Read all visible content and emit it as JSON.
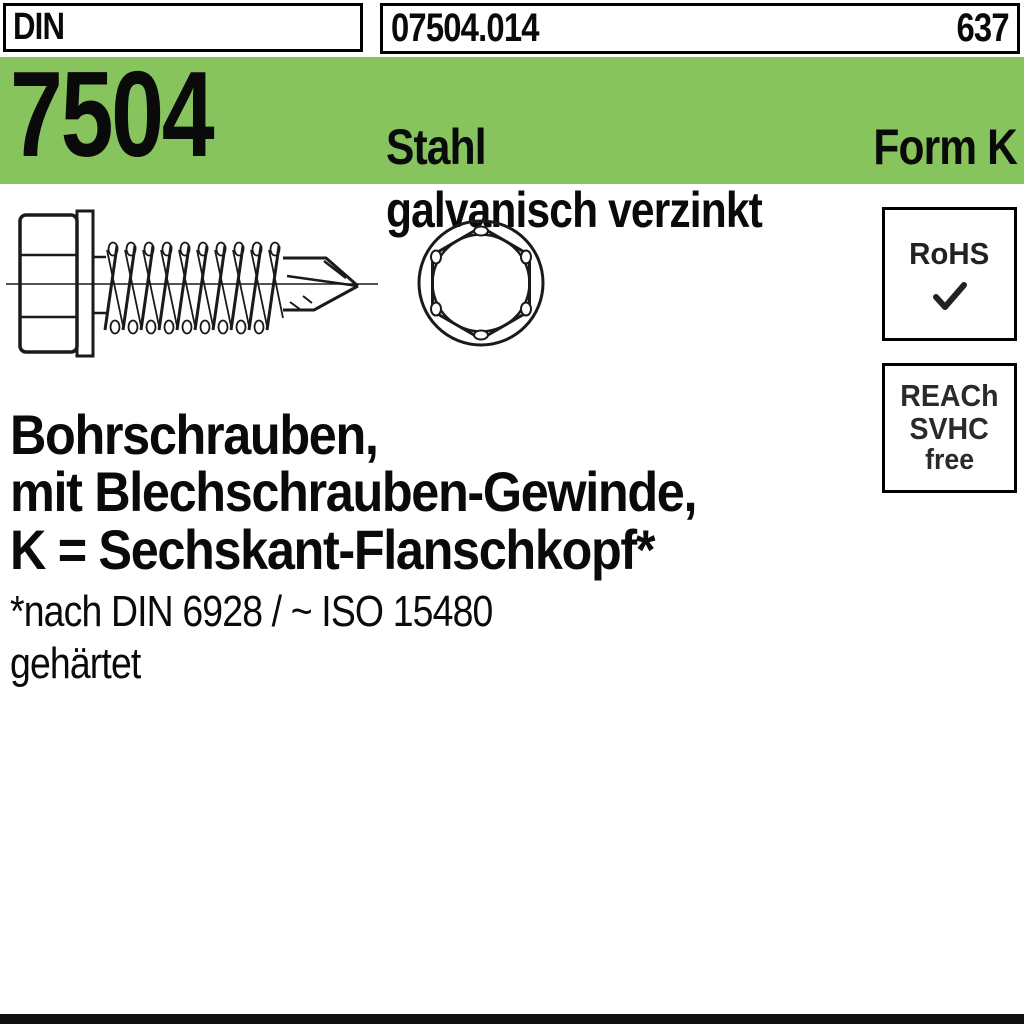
{
  "colors": {
    "banner_green": "#87C45E",
    "text_black": "#0a0a0a",
    "badge_text_gray": "#2a2a2a",
    "bottom_bar_black": "#0f0f0f"
  },
  "header": {
    "din_label": "DIN",
    "article_number": "07504.014",
    "page_number": "637"
  },
  "banner": {
    "standard_number": "7504",
    "material": "Stahl",
    "finish": "galvanisch verzinkt",
    "form": "Form K"
  },
  "drawing": {
    "side_view_icon": "self-drilling-screw-side-view",
    "top_view_icon": "hex-flange-head-top-view"
  },
  "compliance": {
    "rohs_label": "RoHS",
    "rohs_check_icon": "check-icon",
    "reach_line1": "REACh",
    "reach_line2": "SVHC",
    "reach_line3": "free"
  },
  "description": {
    "line1": "Bohrschrauben,",
    "line2": "mit Blechschrauben-Gewinde,",
    "line3": "K = Sechskant-Flanschkopf*",
    "footnote_line1": "*nach DIN 6928 / ~ ISO 15480",
    "footnote_line2": "gehärtet"
  }
}
